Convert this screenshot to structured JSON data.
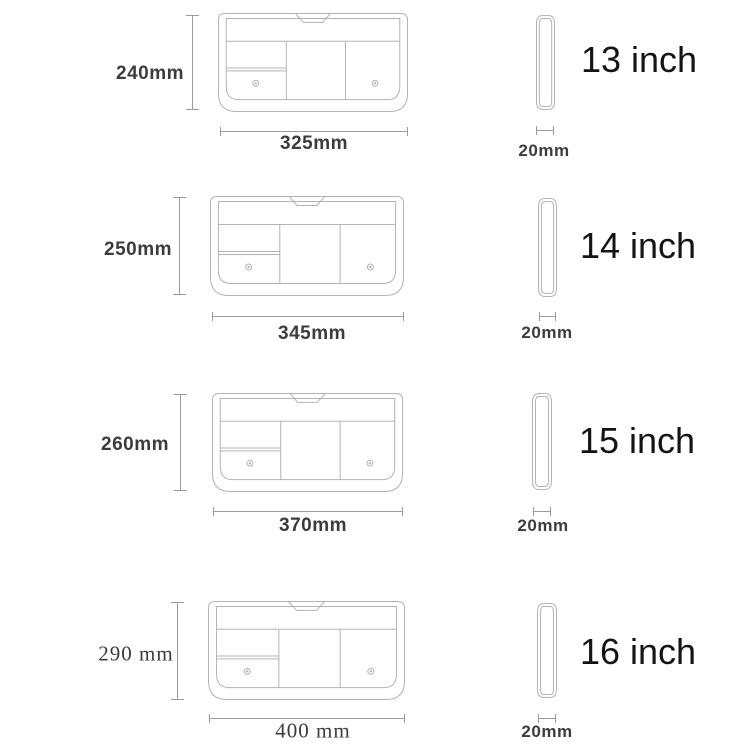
{
  "colors": {
    "bg": "#ffffff",
    "outline": "#b3b3b3",
    "dim": "#9b9b9b",
    "label": "#3c3c3c",
    "inch": "#141414"
  },
  "diagram": {
    "subject": "laptop-sleeve-size-chart",
    "views": [
      "front",
      "side"
    ]
  },
  "rows": [
    {
      "size_label": "13 inch",
      "height_label": "240mm",
      "width_label": "325mm",
      "depth_label": "20mm"
    },
    {
      "size_label": "14 inch",
      "height_label": "250mm",
      "width_label": "345mm",
      "depth_label": "20mm"
    },
    {
      "size_label": "15 inch",
      "height_label": "260mm",
      "width_label": "370mm",
      "depth_label": "20mm"
    },
    {
      "size_label": "16 inch",
      "height_label": "290 mm",
      "width_label": "400 mm",
      "depth_label": "20mm"
    }
  ]
}
